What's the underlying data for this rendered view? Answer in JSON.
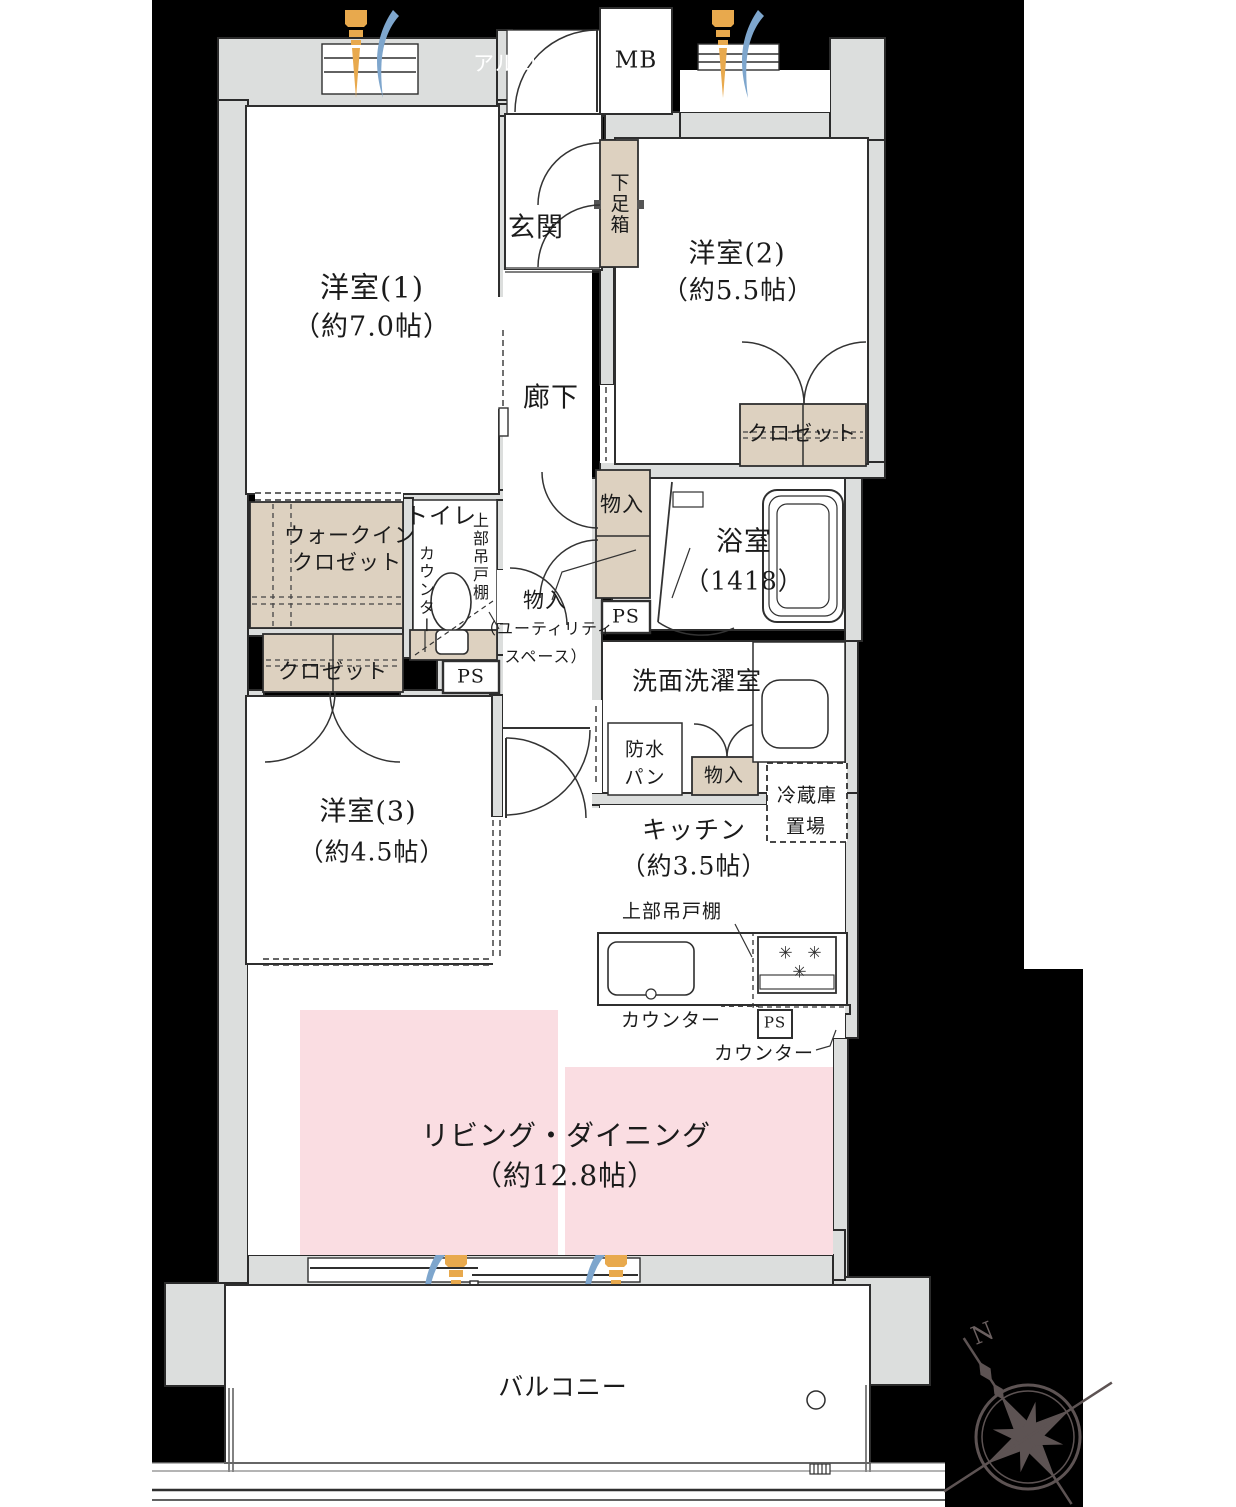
{
  "title": "間取り図（3LDK マンション）",
  "colors": {
    "background": "#000000",
    "wall_fill": "#dcdedd",
    "storage_fill": "#ddd1c0",
    "living_fill": "#fadde2",
    "flame_orange": "#e8a94d",
    "flame_blue": "#7ea6cd",
    "outline": "#2b2b2b",
    "compass": "#5d5353"
  },
  "rooms": {
    "room1": {
      "name": "洋室(1)",
      "size": "（約7.0帖）"
    },
    "room2": {
      "name": "洋室(2)",
      "size": "（約5.5帖）"
    },
    "room3": {
      "name": "洋室(3)",
      "size": "（約4.5帖）"
    },
    "living": {
      "name": "リビング・ダイニング",
      "size": "（約12.8帖）"
    },
    "kitchen": {
      "name": "キッチン",
      "size": "（約3.5帖）"
    },
    "bath": {
      "name": "浴室",
      "size": "（1418）"
    },
    "washroom": {
      "name": "洗面洗濯室"
    },
    "toilet": {
      "name": "トイレ"
    },
    "genkan": {
      "name": "玄関"
    },
    "corridor": {
      "name": "廊下"
    },
    "alcove": {
      "name": "アルコーブ"
    },
    "balcony": {
      "name": "バルコニー"
    }
  },
  "labels": {
    "mb": "MB",
    "shoebox": "下足箱",
    "wic_line1": "ウォークイン",
    "wic_line2": "クロゼット",
    "closet_room2": "クロゼット",
    "closet_room3": "クロゼット",
    "toilet_counter": "カウンター",
    "toilet_cabinet": "上部吊戸棚",
    "storage_hall": "物入",
    "storage_utility_line1": "物入",
    "storage_utility_line2": "（ユーティリティ",
    "storage_utility_line3": "スペース）",
    "ps1": "PS",
    "ps2": "PS",
    "ps3": "PS",
    "pan_line1": "防水",
    "pan_line2": "パン",
    "storage_washroom": "物入",
    "fridge_line1": "冷蔵庫",
    "fridge_line2": "置場",
    "kitchen_cabinet": "上部吊戸棚",
    "kitchen_counter1": "カウンター",
    "kitchen_counter2": "カウンター",
    "compass_north": "N"
  },
  "icons": {
    "burner": "✳"
  }
}
